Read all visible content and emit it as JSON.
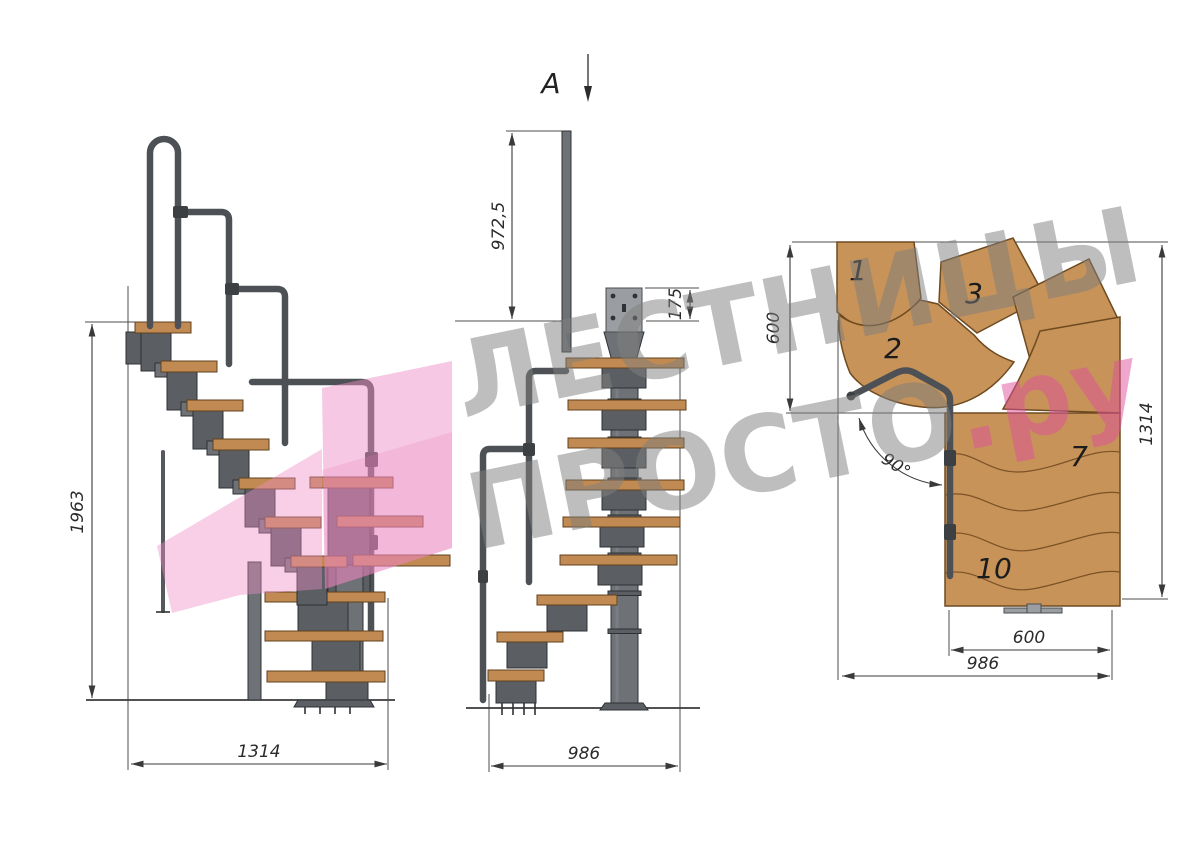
{
  "watermark": {
    "line1": "ЛЕСТНИЦЫ",
    "line2_gray": "ПРОСТО",
    "line2_pink": ".ру"
  },
  "views": {
    "side": {
      "dims": {
        "height": "1963",
        "length": "1314"
      }
    },
    "front": {
      "section_marker": "A",
      "dims": {
        "rail_height": "972,5",
        "plate_height": "175",
        "width": "986"
      }
    },
    "plan": {
      "dims": {
        "entry_depth": "600",
        "depth": "1314",
        "turn_angle": "90°",
        "flight_width": "600",
        "total_width": "986"
      },
      "steps": [
        {
          "number": "1"
        },
        {
          "number": "2"
        },
        {
          "number": "3"
        },
        {
          "number": "7"
        },
        {
          "number": "10"
        }
      ]
    }
  },
  "colors": {
    "wood_side": "#c08a52",
    "wood_plan": "#c79358",
    "metal": "#5b5f63",
    "metal_light": "#9a9ea2",
    "drawing_line": "#3a3a3a",
    "watermark_gray": "#7f7f7f",
    "watermark_pink": "#e0519e",
    "logo_pink": "#ef8cc5"
  }
}
